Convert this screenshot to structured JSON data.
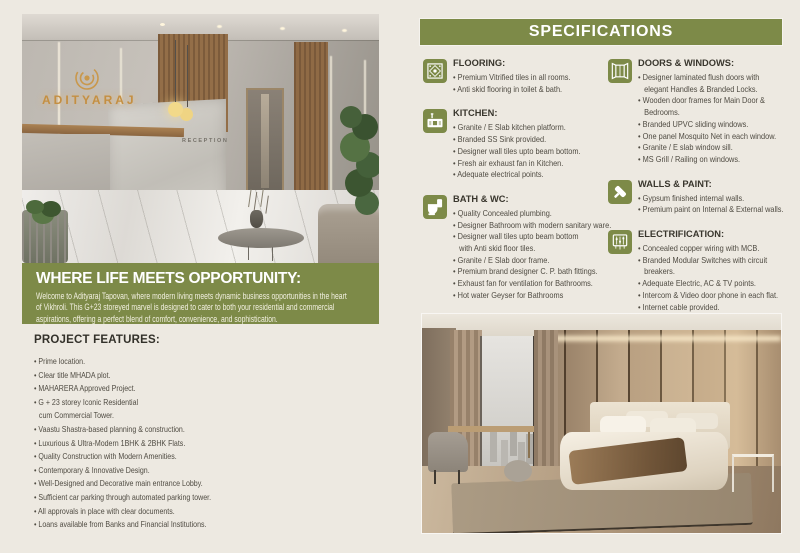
{
  "colors": {
    "page_bg": "#ede9e1",
    "accent_green": "#7d8a48",
    "brand_gold": "#c48f42",
    "heading_text": "#39362d",
    "body_text": "#4f4b42"
  },
  "brand": {
    "logo_text": "ADITYARAJ",
    "reception_sign": "RECEPTION"
  },
  "hero": {
    "heading": "WHERE LIFE MEETS OPPORTUNITY:",
    "body": "Welcome to Adityaraj Tapovan, where modern living meets dynamic business opportunities in the heart\nof Vikhroli. This G+23 storeyed marvel is designed to cater to both your residential and commercial\naspirations, offering a perfect blend of comfort, convenience, and sophistication."
  },
  "features": {
    "heading": "PROJECT FEATURES:",
    "items": [
      "Prime location.",
      "Clear title MHADA plot.",
      "MAHARERA Approved Project.",
      "G + 23 storey Iconic Residential\ncum Commercial Tower.",
      "Vaastu Shastra-based planning & construction.",
      "Luxurious & Ultra-Modern 1BHK & 2BHK Flats.",
      "Quality Construction with Modern Amenities.",
      "Contemporary & Innovative Design.",
      "Well-Designed and Decorative main entrance Lobby.",
      "Sufficient car parking through automated parking tower.",
      "All approvals in place with clear documents.",
      "Loans available from Banks and Financial Institutions."
    ]
  },
  "specifications": {
    "header": "SPECIFICATIONS",
    "columns": [
      [
        {
          "icon": "floor-tile-icon",
          "title": "FLOORING:",
          "items": [
            "Premium Vitrified tiles in all rooms.",
            "Anti skid flooring in toilet & bath."
          ]
        },
        {
          "icon": "kitchen-sink-icon",
          "title": "KITCHEN:",
          "items": [
            "Granite / E Slab kitchen platform.",
            "Branded SS Sink provided.",
            "Designer wall tiles upto beam bottom.",
            "Fresh air exhaust fan in Kitchen.",
            "Adequate electrical points."
          ]
        },
        {
          "icon": "toilet-icon",
          "title": "BATH & WC:",
          "items": [
            "Quality Concealed plumbing.",
            "Designer Bathroom with modern sanitary ware.",
            "Designer wall tiles upto beam bottom\nwith Anti skid floor tiles.",
            "Granite / E Slab door frame.",
            "Premium brand designer C. P. bath fittings.",
            "Exhaust fan for ventilation for Bathrooms.",
            "Hot water Geyser for Bathrooms"
          ]
        }
      ],
      [
        {
          "icon": "window-open-icon",
          "title": "DOORS & WINDOWS:",
          "items": [
            "Designer laminated flush doors with\nelegant Handles & Branded Locks.",
            "Wooden door frames for Main Door &\nBedrooms.",
            "Branded UPVC sliding windows.",
            "One panel Mosquito Net in each window.",
            "Granite / E slab window sill.",
            "MS Grill / Railing on windows."
          ]
        },
        {
          "icon": "paint-roller-icon",
          "title": "WALLS & PAINT:",
          "items": [
            "Gypsum finished internal walls.",
            "Premium paint on Internal & External walls."
          ]
        },
        {
          "icon": "electrical-panel-icon",
          "title": "ELECTRIFICATION:",
          "items": [
            "Concealed copper wiring with MCB.",
            "Branded Modular Switches with circuit\nbreakers.",
            "Adequate Electric, AC & TV points.",
            "Intercom & Video door phone in each flat.",
            "Internet cable provided."
          ]
        }
      ]
    ]
  }
}
